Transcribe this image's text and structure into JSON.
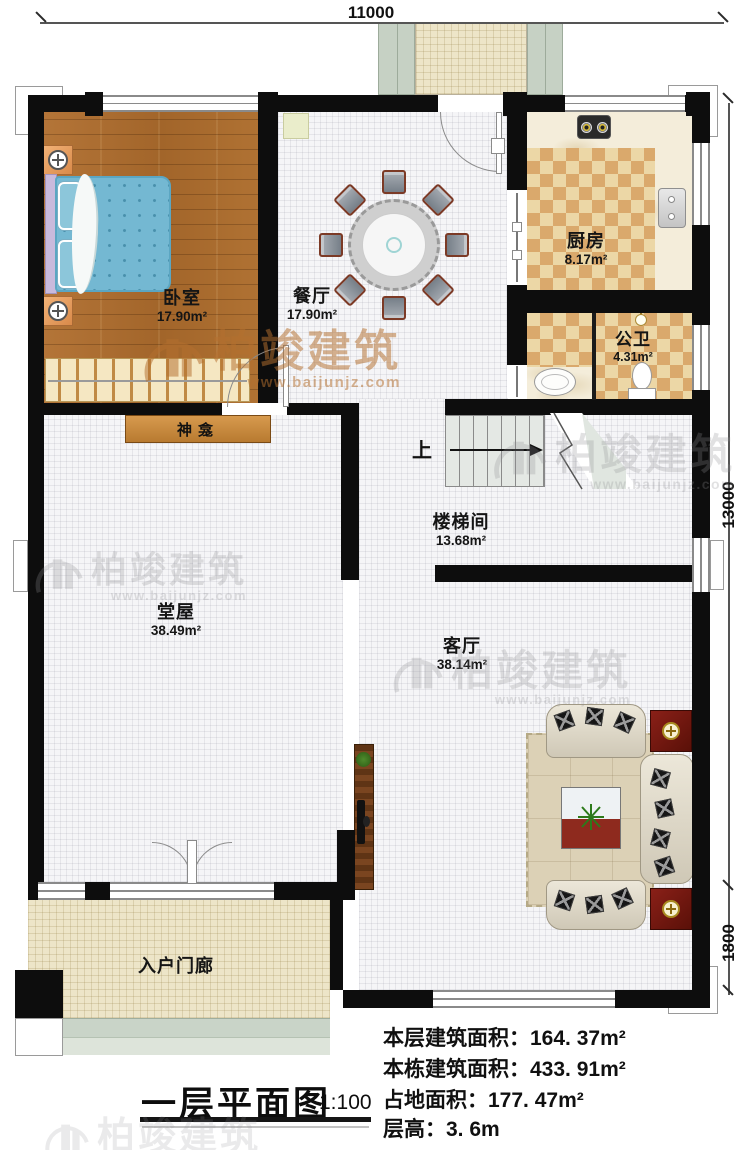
{
  "title": {
    "text": "一层平面图",
    "scale": "1:100"
  },
  "dimensions": {
    "top": "11000",
    "side_main": "13000",
    "side_lower": "1800"
  },
  "rooms": {
    "bedroom": {
      "name": "卧室",
      "area": "17.90m²"
    },
    "dining": {
      "name": "餐厅",
      "area": "17.90m²"
    },
    "kitchen": {
      "name": "厨房",
      "area": "8.17m²"
    },
    "bathroom": {
      "name": "公卫",
      "area": "4.31m²"
    },
    "stairwell": {
      "name": "楼梯间",
      "area": "13.68m²"
    },
    "hall": {
      "name": "堂屋",
      "area": "38.49m²"
    },
    "living": {
      "name": "客厅",
      "area": "38.14m²"
    },
    "porch": {
      "name": "入户门廊"
    }
  },
  "labels": {
    "shrine": "神龛",
    "stairs_up": "上"
  },
  "info": [
    {
      "label": "本层建筑面积：",
      "value": "164. 37m²"
    },
    {
      "label": "本栋建筑面积：",
      "value": "433. 91m²"
    },
    {
      "label": "占地面积：",
      "value": "177. 47m²"
    },
    {
      "label": "层高：",
      "value": "3. 6m"
    }
  ],
  "watermark": {
    "brand": "柏竣建筑",
    "url": "www.baijunjz.com"
  },
  "colors": {
    "wall": "#0d0d0d",
    "checker_dark": "#daa96c",
    "wood": "#ae7136",
    "watermark_orange": "#b5702f"
  }
}
